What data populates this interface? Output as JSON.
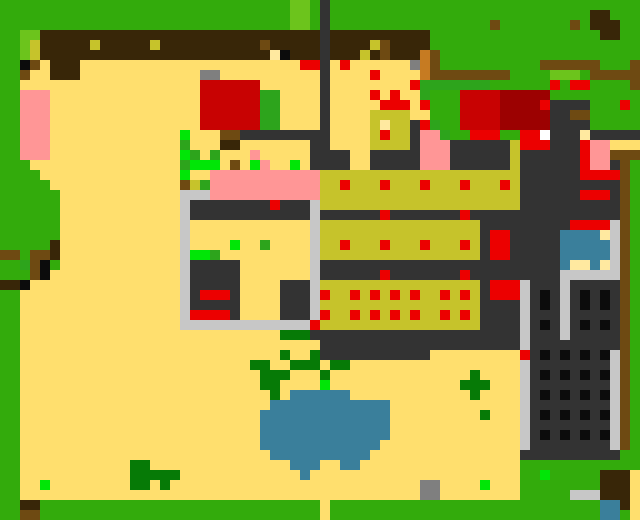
{
  "app": {
    "kind": "pixel-art-game-world-overview",
    "view": "top-down-map",
    "visible_text": []
  },
  "map": {
    "cols": 64,
    "rows": 52,
    "cell_px": 10,
    "palette": {
      "G": {
        "name": "grass",
        "hex": "#33ab0c"
      },
      "g": {
        "name": "light-grass",
        "hex": "#6cc41c"
      },
      "M": {
        "name": "leaf-green",
        "hex": "#2da41c"
      },
      "D": {
        "name": "dark-foliage",
        "hex": "#067a06"
      },
      "L": {
        "name": "bright-plant",
        "hex": "#00e606"
      },
      "Y": {
        "name": "sand",
        "hex": "#ffdf6e"
      },
      "w": {
        "name": "pale-yellow",
        "hex": "#ffe9a0"
      },
      "K": {
        "name": "crop-bed",
        "hex": "#c6c32b"
      },
      "O": {
        "name": "dark-soil",
        "hex": "#382608"
      },
      "B": {
        "name": "wood-brown",
        "hex": "#6e4a12"
      },
      "b": {
        "name": "clay-orange",
        "hex": "#c67b22"
      },
      "E": {
        "name": "stone-gray",
        "hex": "#7f7f7f"
      },
      "A": {
        "name": "wall-light-gray",
        "hex": "#c7c7c7"
      },
      "T": {
        "name": "dark-path",
        "hex": "#333333"
      },
      "R": {
        "name": "red-item",
        "hex": "#ec0000"
      },
      "C": {
        "name": "red-building",
        "hex": "#c80202"
      },
      "r": {
        "name": "dark-red-building",
        "hex": "#9c0101"
      },
      "P": {
        "name": "pink-roof",
        "hex": "#ff9696"
      },
      "U": {
        "name": "water-blue",
        "hex": "#3a7f9b"
      },
      "k": {
        "name": "black",
        "hex": "#0c0c0c"
      },
      "W": {
        "name": "white",
        "hex": "#ffffff"
      }
    },
    "rows_rle": [
      "29G 2g 1G 1T 31G",
      "29G 2g 1G 1T 26G 2O 3G",
      "29G 2g 1G 1T 16G 1B 7G 1B 1G 3O 2G",
      "2G 2g 28O 1T 10O 17G 2O 2G",
      "2G 1g 1K 5O 1K 5O 1K 10O 1B 5O 1T 4O 1K 1B 4O 21G",
      "2G 1g 1K 23O 1w 1k 3O 1T 3O 1K 1O 1B 3O 1b 1B 20G",
      "2G 1k 1B 1Y 3O 22Y 2R 1T 1Y 1R 6Y 1E 1b 1B 10G 6B 3G 1B",
      "2G 1B 2Y 3O 12Y 2E 10Y 1T 4Y 1R 4Y 1b 8B 4G 3g 1G 5B",
      "2G 18Y 6C 6Y 1T 8Y 1R 7M 6G 1R 1G 2R 4G 1B",
      "2G 3P 15Y 6C 2M 4Y 1T 4Y 1R 1Y 1R 2Y 1M 3G 4C 5r 9G",
      "2G 3P 15Y 6C 2M 4Y 1T 5Y 3R 1Y 1R 3G 4C 4r 1R 4T 3G 1R 1G",
      "2G 3P 15Y 6C 2M 4Y 1T 4Y 4K 2Y 3G 4C 5r 2T 2B 5G",
      "2G 3P 15Y 6C 2M 4Y 1T 4Y 1K 1w 2K 1T 1R 1M 2G 4C 5r 4T 5G",
      "2G 3P 13Y 1L 3Y 2B 9T 4Y 1K 1R 2K 1T 2P 1M 2G 3R 2G 2R 1W 3T 1w 5T",
      "2G 3P 13Y 1M 3Y 2O 7Y 2T 4Y 4K 1T 3P 6T 1K 3R 3T 1R 2P 3Y",
      "2G 3P 13Y 1L 1M 1Y 1M 3Y 1P 5Y 4T 2Y 5T 3P 6T 1K 6T 1R 2P 3B",
      "3G 15Y 1M 3L 1Y 1B 1Y 1L 1P 2Y 1L 1Y 4T 2Y 5T 3P 6T 1K 6T 1R 2P 1T 1B 1G",
      "4G 14Y 1L 2Y 11P 20K 6T 4R 1B 1G",
      "5G 13Y 1B 1K 1M 11P 2K 1R 3K 1R 3K 1R 3K 1R 3K 1R 1K 10T 1B 1G",
      "6G 12Y 3A 11P 20K 6T 3R 1T 1B 1G",
      "6G 12Y 1A 8T 1R 3T 1A 20K 10T 1B 1G",
      "6G 12Y 1A 12T 1A 6T 1R 7T 1R 15T 1B 1G",
      "6G 12Y 1A 12Y 1A 16K 9T 4R 1A 1B 1G",
      "6G 12Y 1A 12Y 1A 16K 1T 2R 5T 4U 1w 1A 1B 1G",
      "5G 1O 12Y 1A 4Y 1L 2Y 1M 4Y 1A 2K 1R 3K 1R 3K 1R 3K 1R 1K 1T 2R 5T 5U 1A 1B 1G",
      "2B 1G 2B 1O 12Y 1A 2L 1M 9Y 1A 16K 1T 2R 5T 5U 1A 1B 1G",
      "2G 1M 1B 1k 1G 12Y 1A 5T 7Y 1A 24T 1U 2w 1U 1w 1A 1B 1G",
      "3G 1B 1k 13Y 1A 5T 7Y 1A 6T 1R 7T 1R 9T 6A 1B 1G",
      "2O 1k 15Y 1A 5T 4Y 3T 1A 16K 1T 3R 1A 3T 1A 5T 1B 1G",
      "2G 16Y 1A 1T 3R 1T 4Y 3T 1A 1R 2K 1R 1K 1R 1K 1R 1K 1R 2K 1R 1K 1R 1K 1T 3R 1A 1T 1k 1T 1A 1T 1k 1T 1k 1T 1B 1G",
      "2G 16Y 1A 5T 4Y 3T 1A 16K 4T 1A 1T 1k 1T 1A 1T 1k 1T 1k 1T 1B 1G",
      "2G 16Y 1A 4R 1T 4Y 3T 1A 1R 2K 1R 1K 1R 1K 1R 1K 1R 2K 1R 1K 1R 1K 4T 1A 3T 1A 5T 1B 1G",
      "2G 16Y 13A 1R 16K 4T 1A 1T 1k 1T 1A 1T 1k 1T 1k 1T 1B 1G",
      "2G 26Y 3D 21T 1A 3T 1A 5T 1B 1G",
      "2G 30Y 20T 1A 9T 1B 1G",
      "2G 26Y 1D 2Y 1D 11T 9Y 1R 1T 1k 1T 1k 1T 1k 1T 1k 1A 1B 1G",
      "2G 23Y 2D 2Y 3D 1Y 2D 17Y 1A 8T 1A 1B 1G",
      "2G 24Y 3D 3Y 1D 14Y 1D 4Y 1A 1T 1k 1T 1k 1T 1k 1T 1k 1A 1B 1G",
      "2G 24Y 2D 4Y 1L 13Y 3D 3Y 1A 8T 1A 1B 1G",
      "2G 25Y 1D 1Y 6U 12Y 1D 4Y 1A 1T 1k 1T 1k 1T 1k 1T 1k 1A 1B 1G",
      "2G 25Y 12U 13Y 1A 8T 1A 1B 1G",
      "2G 24Y 13U 9Y 1D 3Y 1A 1T 1k 1T 1k 1T 1k 1T 1k 1A 1B 1G",
      "2G 24Y 13U 13Y 1A 8T 1A 1B 1G",
      "2G 24Y 13U 13Y 1A 1T 1k 1T 1k 1T 1k 1T 1k 1A 1B 1G",
      "2G 24Y 12U 14Y 1A 8T 1A 1B 1G",
      "2G 25Y 10U 15Y 10T 2G",
      "2G 11Y 2D 14Y 3U 2Y 2U 16Y 12G",
      "2G 11Y 5D 12Y 1U 21Y 2G 1L 5G 3O 1Y",
      "2G 2Y 1L 8Y 2D 1Y 1D 25Y 2E 4Y 1L 3Y 8G 3O 1Y",
      "2G 40Y 2E 8Y 5G 3A 3O 1Y",
      "2G 2O 28G 1Y 27G 2U 1O 1Y",
      "2G 2B 28G 1Y 27G 2U 1G 1Y"
    ]
  }
}
